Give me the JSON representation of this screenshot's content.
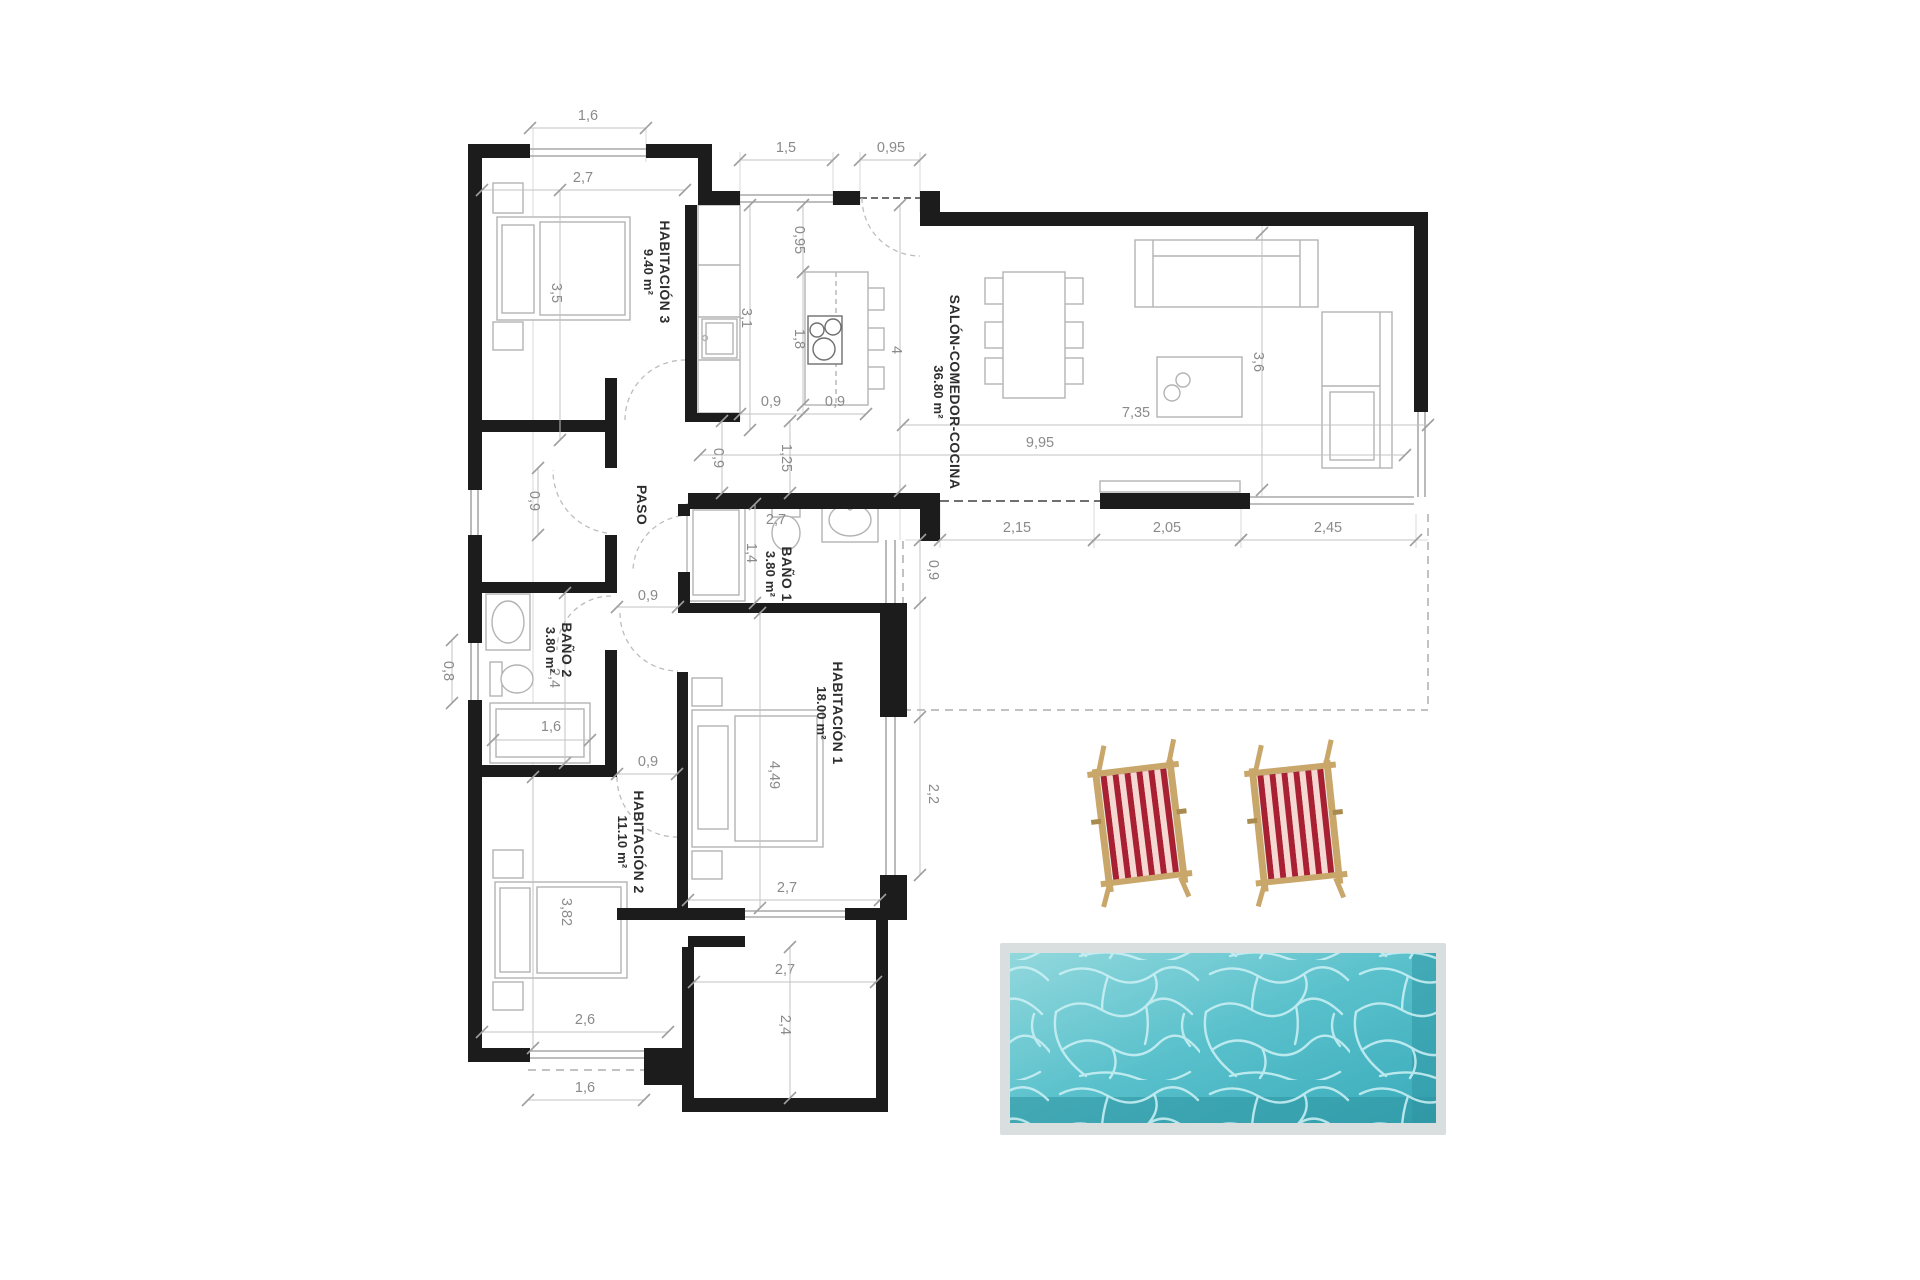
{
  "title": "Plano de vivienda con piscina",
  "colors": {
    "wall_ink": "#1c1c1c",
    "thin_line": "#a8a8a8",
    "ext_line": "#d9d9d9",
    "dim_line": "#c3c3c3",
    "tick": "#9f9f9f",
    "dim_text": "#8a8a8a",
    "label_text": "#2e2e2e",
    "furniture": "#b3b3b3",
    "door_arc": "#bdbdbd",
    "terrace_dash": "#aeaeae",
    "opening_dash": "#6f6f6f",
    "pool_frame": "#d9dede",
    "pool_water_light": "#92d8dd",
    "pool_water_mid": "#58c0cb",
    "pool_water_dark": "#3aabba",
    "pool_shadow": "#2d93a1",
    "caustic": "#cdf1f5",
    "chair_red": "#a82032",
    "chair_pink": "#f6d8d2",
    "chair_wood": "#c9a76a",
    "chair_wood_dark": "#a98b4f"
  },
  "rooms": [
    {
      "id": "habitacion-3",
      "name": "HABITACIÓN 3",
      "area": "9.40 m²"
    },
    {
      "id": "salon-comedor-cocina",
      "name": "SALÓN-COMEDOR-COCINA",
      "area": "36.80 m²"
    },
    {
      "id": "paso",
      "name": "PASO",
      "area": ""
    },
    {
      "id": "bano-1",
      "name": "BAÑO 1",
      "area": "3.80 m²"
    },
    {
      "id": "bano-2",
      "name": "BAÑO 2",
      "area": "3.80 m²"
    },
    {
      "id": "habitacion-1",
      "name": "HABITACIÓN 1",
      "area": "18.00 m²"
    },
    {
      "id": "habitacion-2",
      "name": "HABITACIÓN 2",
      "area": "11.10 m²"
    }
  ],
  "dimensions": {
    "d_hab3_win": "1,6",
    "d_hab3_w": "2,7",
    "d_hab3_h": "3,5",
    "d_kitchen_win": "1,5",
    "d_entry": "0,95",
    "d_k_v095": "0,95",
    "d_k_31": "3,1",
    "d_k_18": "1,8",
    "d_k_4": "4",
    "d_k_09a": "0,9",
    "d_k_09b": "0,9",
    "d_k_09v": "0,9",
    "d_k_125": "1,25",
    "d_salon_735": "7,35",
    "d_salon_995": "9,95",
    "d_salon_36": "3,6",
    "d_t_215": "2,15",
    "d_t_205": "2,05",
    "d_t_245": "2,45",
    "d_paso_09": "0,9",
    "d_closet_09": "0,9",
    "d_b1_27": "2,7",
    "d_b1_14": "1,4",
    "d_b2_08": "0,8",
    "d_b2_24": "2,4",
    "d_b2_16": "1,6",
    "d_b2_09": "0,9",
    "d_h1_449": "4,49",
    "d_h1_27": "2,7",
    "d_h1_22": "2,2",
    "d_h1_09": "0,9",
    "d_h2_382": "3,82",
    "d_h2_26": "2,6",
    "d_h2_16": "1,6",
    "d_ext_27": "2,7",
    "d_ext_24": "2,4"
  }
}
